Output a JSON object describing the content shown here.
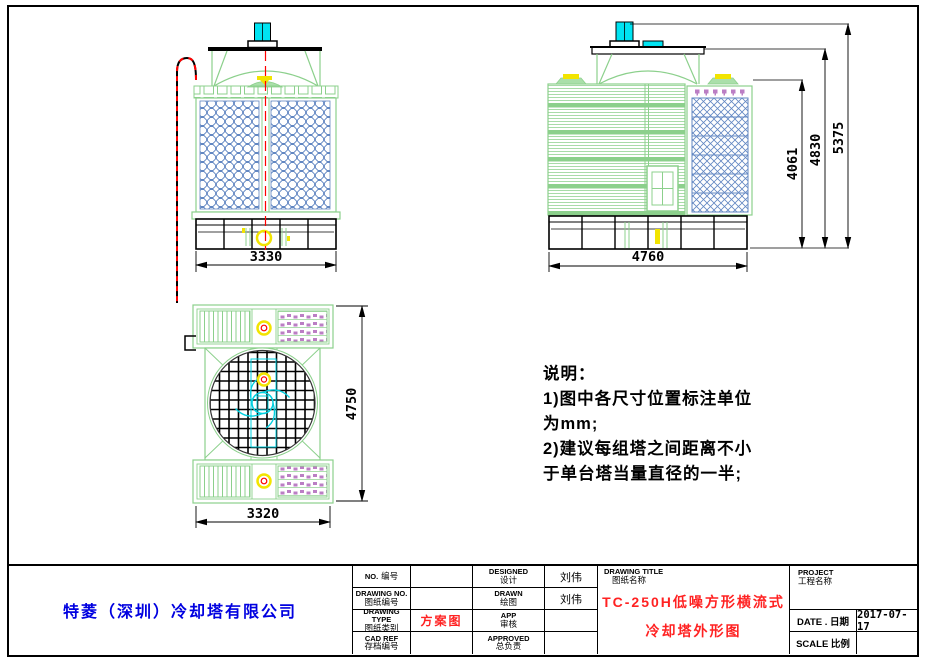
{
  "dimensions": {
    "front_width": "3330",
    "side_width": "4760",
    "side_height_inner": "4061",
    "side_height_mid": "4830",
    "side_height_total": "5375",
    "plan_depth": "4750",
    "plan_width": "3320"
  },
  "notes": {
    "heading": "说明：",
    "line1": "1)图中各尺寸位置标注单位",
    "line2": "为mm;",
    "line3": "2)建议每组塔之间距离不小",
    "line4": "于单台塔当量直径的一半;"
  },
  "title_block": {
    "company": "特菱（深圳）冷却塔有限公司",
    "no": {
      "en": "NO.",
      "zh": "编号",
      "value": ""
    },
    "drawing_no": {
      "en": "DRAWING NO.",
      "zh": "图纸编号",
      "value": ""
    },
    "drawing_type": {
      "en": "DRAWING TYPE",
      "zh": "图纸类别",
      "value": "方案图"
    },
    "cad_ref": {
      "en": "CAD REF",
      "zh": "存档编号",
      "value": ""
    },
    "designed": {
      "en": "DESIGNED",
      "zh": "设计",
      "value": "刘伟"
    },
    "drawn": {
      "en": "DRAWN",
      "zh": "绘图",
      "value": "刘伟"
    },
    "app": {
      "en": "APP",
      "zh": "审核",
      "value": ""
    },
    "approved": {
      "en": "APPROVED",
      "zh": "总负责",
      "value": ""
    },
    "drawing_title": {
      "en": "DRAWING TITLE",
      "zh": "图纸名称",
      "line1": "TC-250H低噪方形横流式",
      "line2": "冷却塔外形图"
    },
    "project": {
      "en": "PROJECT",
      "zh": "工程名称",
      "value": ""
    },
    "date": {
      "label": "DATE . 日期",
      "value": "2017-07-17"
    },
    "scale": {
      "label": "SCALE 比例",
      "value": ""
    }
  },
  "colors": {
    "frame_green": "#8cd08c",
    "fill_blue": "#6287c2",
    "motor_cyan": "#00e4f2",
    "pipe_yellow": "#f2e400",
    "centerline_red": "#ff0000",
    "nozzle_purple": "#bb7ec4",
    "company_blue": "#0000e0",
    "title_red": "#ff2222"
  }
}
